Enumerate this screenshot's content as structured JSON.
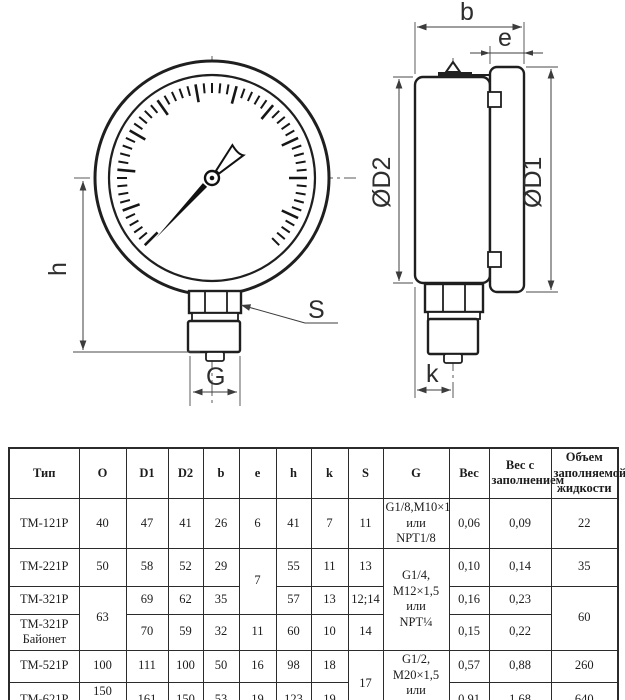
{
  "drawing": {
    "labels": {
      "h": "h",
      "G": "G",
      "S": "S",
      "b": "b",
      "e": "e",
      "k": "k",
      "d1": "ØD1",
      "d2": "ØD2"
    },
    "line_color": "#1f1f1f",
    "background": "#ffffff"
  },
  "table": {
    "headers": [
      "Тип",
      "O",
      "D1",
      "D2",
      "b",
      "e",
      "h",
      "k",
      "S",
      "G",
      "Вес",
      "Вес с\nзаполнением",
      "Объем\nзаполняемой\nжидкости"
    ],
    "col_widths": [
      70,
      47,
      42,
      35,
      36,
      37,
      35,
      37,
      35,
      66,
      40,
      62,
      67
    ],
    "rows": [
      {
        "cells": [
          {
            "t": "ТМ-121Р"
          },
          {
            "t": "40"
          },
          {
            "t": "47"
          },
          {
            "t": "41"
          },
          {
            "t": "26"
          },
          {
            "t": "6"
          },
          {
            "t": "41"
          },
          {
            "t": "7"
          },
          {
            "t": "11"
          },
          {
            "t": "G1/8,М10×1\nили NPT1/8"
          },
          {
            "t": "0,06"
          },
          {
            "t": "0,09"
          },
          {
            "t": "22"
          }
        ]
      },
      {
        "cells": [
          {
            "t": "ТМ-221Р"
          },
          {
            "t": "50"
          },
          {
            "t": "58"
          },
          {
            "t": "52"
          },
          {
            "t": "29"
          },
          {
            "t": "7",
            "rs": 2
          },
          {
            "t": "55"
          },
          {
            "t": "11"
          },
          {
            "t": "13"
          },
          {
            "t": "G1/4,\nМ12×1,5\nили\nNPT¼",
            "rs": 3
          },
          {
            "t": "0,10"
          },
          {
            "t": "0,14"
          },
          {
            "t": "35"
          }
        ]
      },
      {
        "cells": [
          {
            "t": "ТМ-321Р"
          },
          {
            "t": "63",
            "rs": 2
          },
          {
            "t": "69"
          },
          {
            "t": "62"
          },
          {
            "t": "35"
          },
          {
            "t": "57"
          },
          {
            "t": "13"
          },
          {
            "t": "12;14"
          },
          {
            "t": "0,16"
          },
          {
            "t": "0,23"
          },
          {
            "t": "60",
            "rs": 2
          }
        ]
      },
      {
        "cells": [
          {
            "t": "ТМ-321Р\nБайонет"
          },
          {
            "t": "70"
          },
          {
            "t": "59"
          },
          {
            "t": "32"
          },
          {
            "t": "11"
          },
          {
            "t": "60"
          },
          {
            "t": "10"
          },
          {
            "t": "14"
          },
          {
            "t": "0,15"
          },
          {
            "t": "0,22"
          }
        ]
      },
      {
        "cells": [
          {
            "t": "ТМ-521Р"
          },
          {
            "t": "100"
          },
          {
            "t": "111"
          },
          {
            "t": "100"
          },
          {
            "t": "50"
          },
          {
            "t": "16"
          },
          {
            "t": "98"
          },
          {
            "t": "18"
          },
          {
            "t": "17",
            "rs": 2
          },
          {
            "t": "G1/2,\nМ20×1,5\nили\nNPT½",
            "rs": 2
          },
          {
            "t": "0,57"
          },
          {
            "t": "0,88"
          },
          {
            "t": "260"
          }
        ]
      },
      {
        "cells": [
          {
            "t": "ТМ-621Р"
          },
          {
            "t": "150\n/160*"
          },
          {
            "t": "161"
          },
          {
            "t": "150"
          },
          {
            "t": "53"
          },
          {
            "t": "19"
          },
          {
            "t": "123"
          },
          {
            "t": "19"
          },
          {
            "t": "0,91"
          },
          {
            "t": "1,68"
          },
          {
            "t": "640"
          }
        ]
      }
    ]
  }
}
